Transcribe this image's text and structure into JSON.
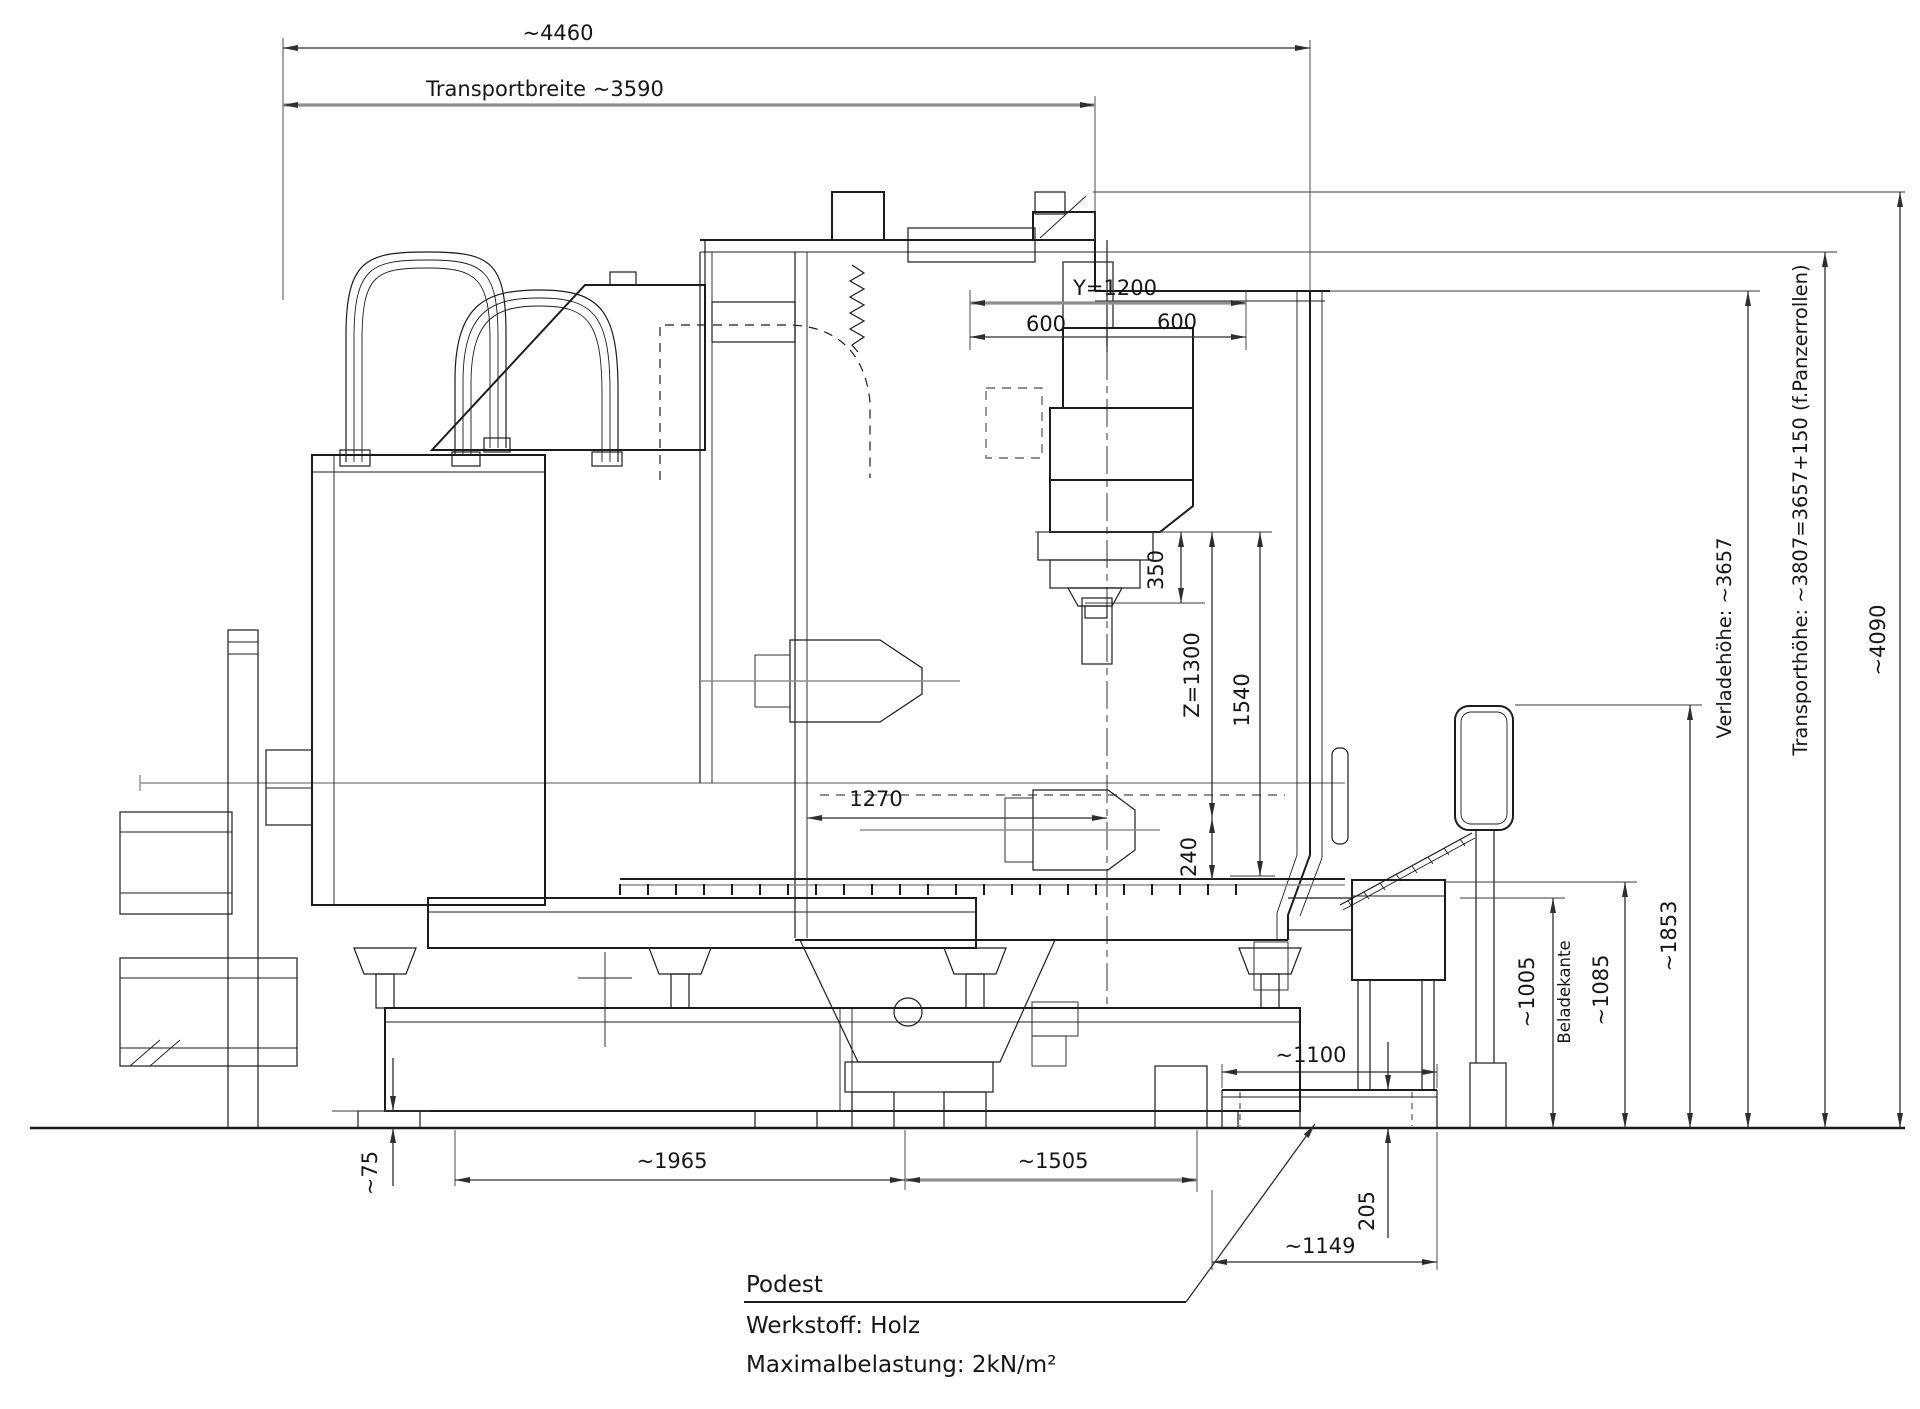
{
  "drawing": {
    "dims": {
      "overall_width": "~4460",
      "transport_width": "Transportbreite ~3590",
      "y_travel": "Y=1200",
      "y_left": "600",
      "y_right": "600",
      "spindle_350": "350",
      "z_travel": "Z=1300",
      "v_1540": "1540",
      "h_1270": "1270",
      "v_240": "240",
      "v_1005": "~1005",
      "beladekante": "Beladekante",
      "v_1085": "~1085",
      "v_1853": "~1853",
      "verladehoehe": "Verladehöhe: ~3657",
      "transporthoehe": "Transporthöhe: ~3807=3657+150 (f.Panzerrollen)",
      "total_height": "~4090",
      "v_75": "~75",
      "h_1965": "~1965",
      "h_1505": "~1505",
      "h_1100": "~1100",
      "v_205": "205",
      "h_1149": "~1149"
    },
    "notes": {
      "line1": "Podest",
      "line2": "Werkstoff: Holz",
      "line3": "Maximalbelastung: 2kN/m²"
    },
    "colors": {
      "ink": "#1c1c1c",
      "dim_line": "#2e2e2e",
      "gray_line": "#8f8f8f",
      "background": "#ffffff"
    }
  }
}
